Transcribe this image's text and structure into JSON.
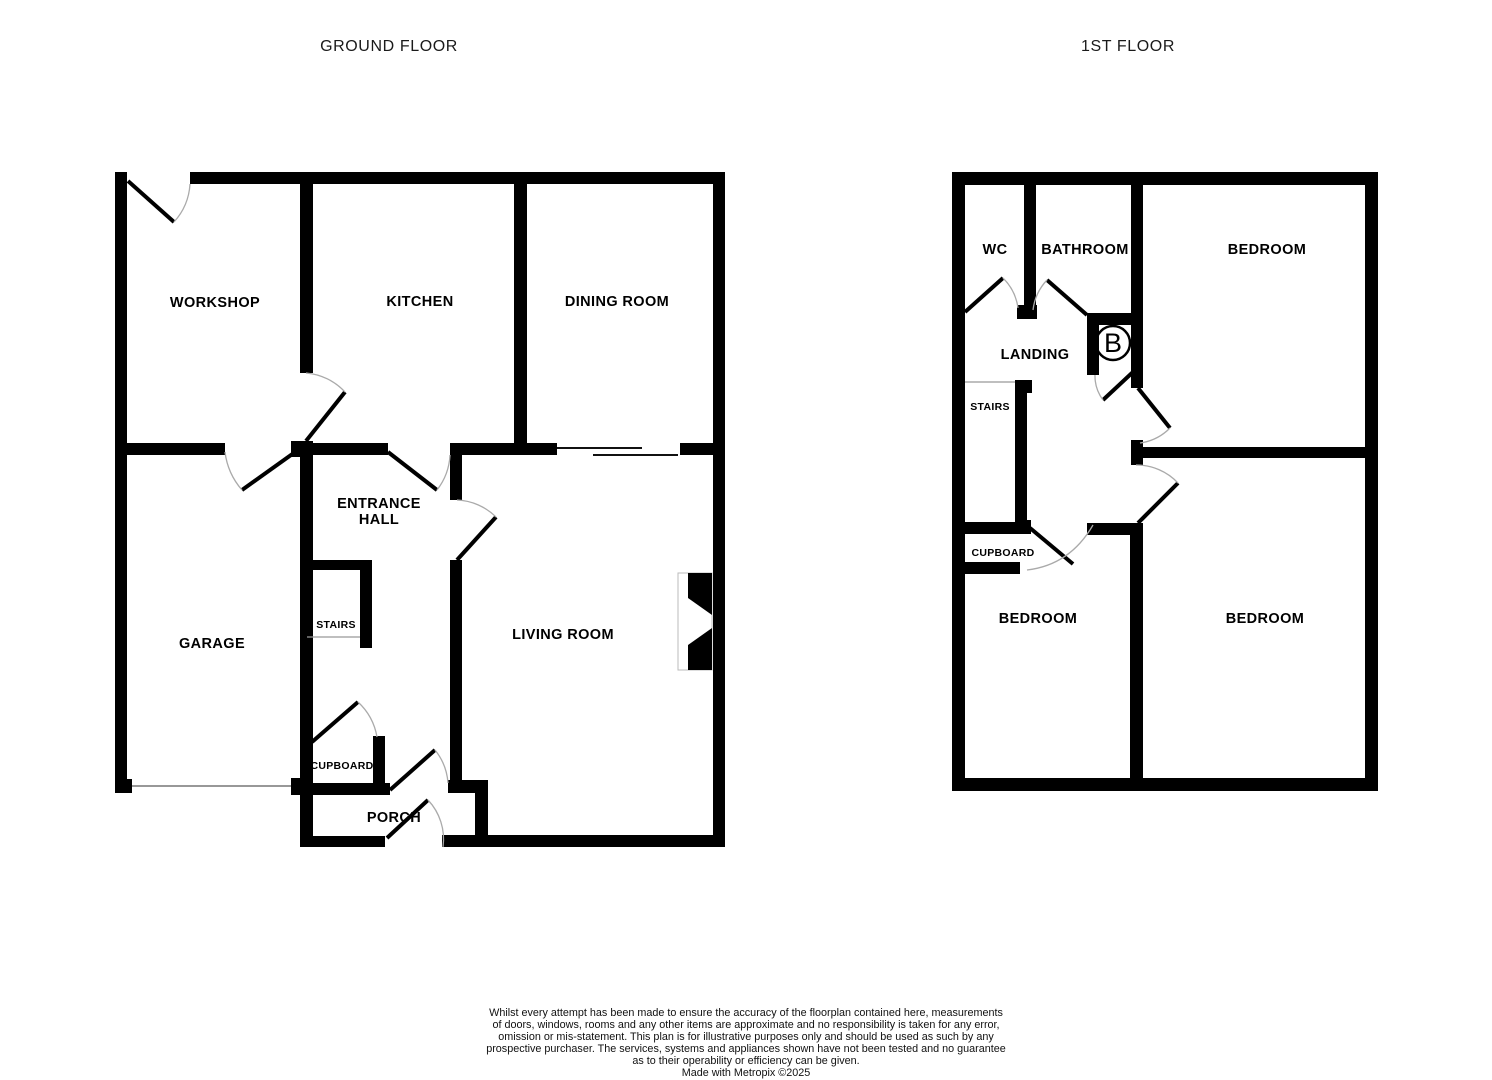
{
  "ground": {
    "title": "GROUND FLOOR",
    "rooms": {
      "workshop": "WORKSHOP",
      "kitchen": "KITCHEN",
      "dining_room": "DINING ROOM",
      "entrance_hall_line1": "ENTRANCE",
      "entrance_hall_line2": "HALL",
      "garage": "GARAGE",
      "stairs": "STAIRS",
      "living_room": "LIVING ROOM",
      "cupboard": "CUPBOARD",
      "porch": "PORCH"
    }
  },
  "first": {
    "title": "1ST FLOOR",
    "rooms": {
      "wc": "WC",
      "bathroom": "BATHROOM",
      "bedroom_top": "BEDROOM",
      "landing": "LANDING",
      "stairs": "STAIRS",
      "cupboard": "CUPBOARD",
      "bedroom_left": "BEDROOM",
      "bedroom_right": "BEDROOM"
    },
    "boiler_label": "B"
  },
  "footer": {
    "lines": [
      "Whilst every attempt has been made to ensure the accuracy of the floorplan contained here, measurements",
      "of doors, windows, rooms and any other items are approximate and no responsibility is taken for any error,",
      "omission or mis-statement. This plan is for illustrative purposes only and should be used as such by any",
      "prospective purchaser. The services, systems and appliances shown have not been tested and no guarantee",
      "as to their operability or efficiency can be given."
    ],
    "credit": "Made with Metropix ©2025"
  },
  "colors": {
    "wall": "#000000",
    "door_arc": "#aaaaaa",
    "text": "#000000",
    "background": "#ffffff"
  }
}
